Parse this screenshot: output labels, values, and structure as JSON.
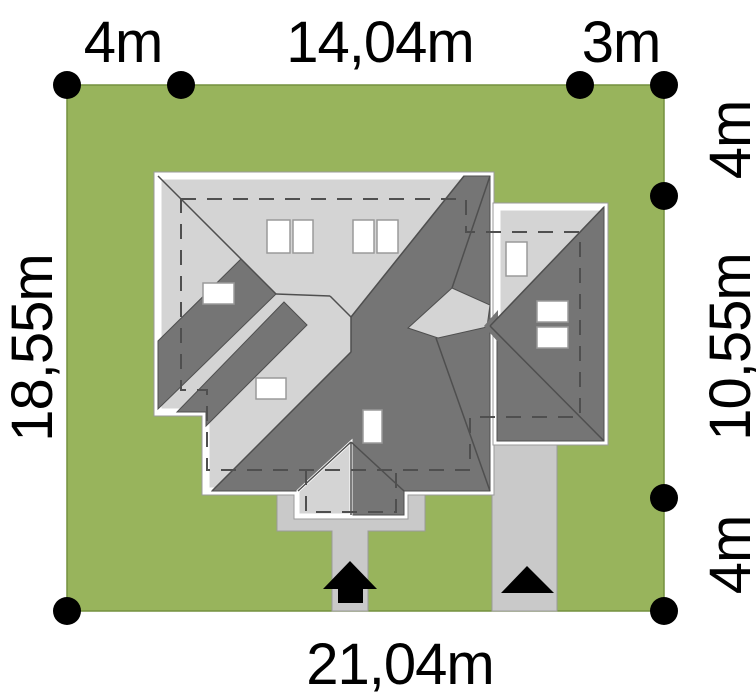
{
  "plan_title": "house-plot-site-plan",
  "dimensions": {
    "top_left": "4m",
    "top_center": "14,04m",
    "top_right": "3m",
    "right_top": "4m",
    "right_middle": "10,55m",
    "right_bottom": "4m",
    "left_side": "18,55m",
    "bottom": "21,04m"
  },
  "colors": {
    "plot_green": "#98b45c",
    "plot_border": "#74903f",
    "roof_light": "#d4d4d4",
    "roof_dark": "#757575",
    "roof_line": "#4f4f4f",
    "paving_gray": "#c9c9c9",
    "paving_border": "#9a9a9a",
    "marker_black": "#000000",
    "roof_outline_white": "#ffffff"
  },
  "markers": {
    "boundary_dot_count": 8,
    "entrance_arrows": [
      "pedestrian-entrance",
      "driveway-entrance"
    ]
  }
}
